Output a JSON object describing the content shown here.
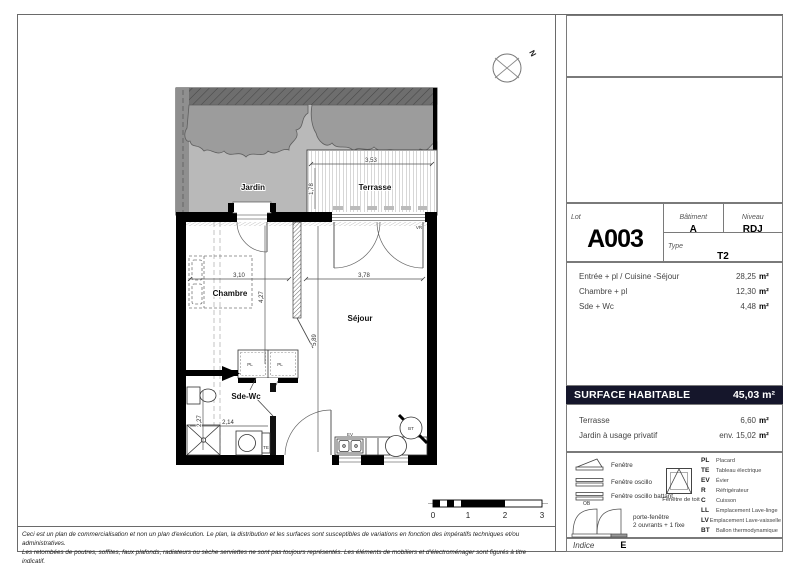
{
  "compass": {
    "north_label": "N"
  },
  "plan": {
    "rooms": {
      "jardin": "Jardin",
      "terrasse": "Terrasse",
      "chambre": "Chambre",
      "sejour": "Séjour",
      "sde_wc": "Sde-Wc"
    },
    "labels": {
      "pl": "PL",
      "te": "TE",
      "ev": "EV",
      "bt": "BT",
      "vr": "VR"
    },
    "dimensions": {
      "terrasse_w": "3,53",
      "terrasse_d": "1,78",
      "chambre_w": "3,10",
      "chambre_h": "4,27",
      "sejour_w": "3,78",
      "sejour_h": "5,89",
      "sde_h": "2,27",
      "sde_w": "2,14"
    }
  },
  "scale_bar": {
    "ticks": [
      "0",
      "1",
      "2",
      "3"
    ]
  },
  "title_block": {
    "lot_label": "Lot",
    "lot_value": "A003",
    "batiment_label": "Bâtiment",
    "batiment_value": "A",
    "niveau_label": "Niveau",
    "niveau_value": "RDJ",
    "type_label": "Type",
    "type_value": "T2",
    "rooms": [
      {
        "name": "Entrée + pl / Cuisine -Séjour",
        "area": "28,25",
        "unit": "m²"
      },
      {
        "name": "Chambre + pl",
        "area": "12,30",
        "unit": "m²"
      },
      {
        "name": "Sde + Wc",
        "area": "4,48",
        "unit": "m²"
      }
    ],
    "surface_habitable": {
      "label": "SURFACE HABITABLE",
      "value": "45,03",
      "unit": "m²"
    },
    "annexes": [
      {
        "name": "Terrasse",
        "area": "6,60",
        "unit": "m²"
      },
      {
        "name": "Jardin à usage privatif",
        "area": "env. 15,02",
        "unit": "m²"
      }
    ],
    "indice_label": "Indice",
    "indice_value": "E"
  },
  "legend": {
    "windows": [
      {
        "label": "Fenêtre"
      },
      {
        "label": "Fenêtre oscillo"
      },
      {
        "label": "Fenêtre oscillo battant",
        "sub": "OB"
      },
      {
        "label": "Fenêtre de toit"
      }
    ],
    "porte_fenetre": {
      "line1": "porte-fenêtre",
      "line2": "2 ouvrants + 1 fixe"
    },
    "abbreviations": [
      {
        "abbr": "PL",
        "label": "Placard"
      },
      {
        "abbr": "TE",
        "label": "Tableau électrique"
      },
      {
        "abbr": "EV",
        "label": "Évier"
      },
      {
        "abbr": "R",
        "label": "Réfrigérateur"
      },
      {
        "abbr": "C",
        "label": "Cuisson"
      },
      {
        "abbr": "LL",
        "label": "Emplacement Lave-linge"
      },
      {
        "abbr": "LV",
        "label": "Emplacement Lave-vaisselle"
      },
      {
        "abbr": "BT",
        "label": "Ballon thermodynamique"
      }
    ]
  },
  "disclaimer": {
    "line1": "Ceci est un plan de commercialisation et non un plan d'exécution. Le plan, la distribution et les surfaces sont susceptibles de variations en fonction des impératifs techniques et/ou administratives.",
    "line2": "Les retombées de poutres, soffites, faux plafonds, radiateurs ou sèche serviettes ne sont pas toujours représentés. Les éléments de mobiliers et d'électroménager sont figurés à titre indicatif."
  }
}
